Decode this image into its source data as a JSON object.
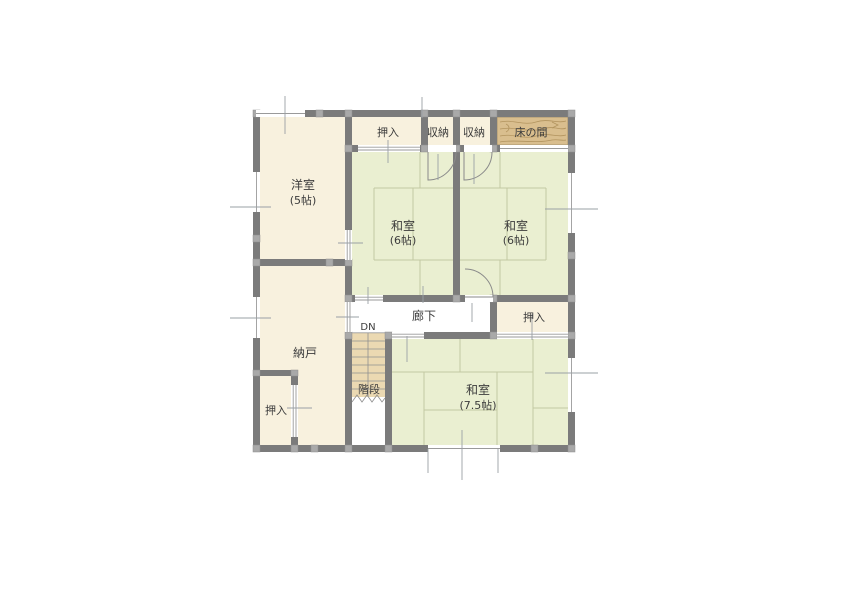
{
  "floorplan": {
    "title": "2F floor plan",
    "rooms": {
      "western_room": {
        "name": "洋室",
        "size": "(5帖)"
      },
      "washitsu_nw": {
        "name": "和室",
        "size": "(6帖)"
      },
      "washitsu_ne": {
        "name": "和室",
        "size": "(6帖)"
      },
      "washitsu_s": {
        "name": "和室",
        "size": "(7.5帖)"
      },
      "storeroom": {
        "name": "納戸"
      },
      "hallway": {
        "name": "廊下"
      },
      "stairs": {
        "name": "階段"
      },
      "stairs_direction": "DN",
      "closet_top": {
        "name": "押入"
      },
      "storage_1": {
        "name": "収納"
      },
      "storage_2": {
        "name": "収納"
      },
      "tokonoma": {
        "name": "床の間"
      },
      "closet_east": {
        "name": "押入"
      },
      "closet_sw": {
        "name": "押入"
      }
    },
    "colors": {
      "wall": "#7b7b7b",
      "post": "#a9a9a9",
      "tatami": "#eaefd1",
      "tatami_line": "#c3c9a2",
      "cream": "#f8f1de",
      "wood": "#d9be8e",
      "wood_grain": "#b2945f",
      "stairs": "#ebd9b2",
      "hallway": "#ffffff",
      "text": "#3c3c3c",
      "dimension": "#9aa0a5"
    }
  }
}
